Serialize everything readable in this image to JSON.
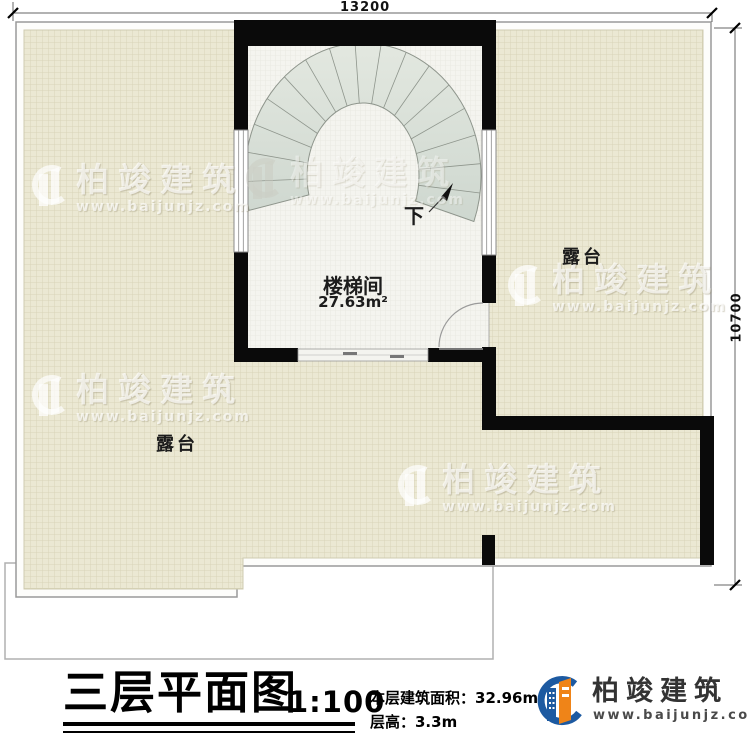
{
  "dimensions": {
    "top": "13200",
    "right": "10700"
  },
  "rooms": {
    "stair_room_label": "楼梯间",
    "stair_room_area": "27.63m²",
    "terrace_right_label": "露台",
    "terrace_bottom_label": "露台",
    "down_label": "下"
  },
  "title_block": {
    "title": "三层平面图",
    "scale": "1:100",
    "area_line": "本层建筑面积：32.96m²",
    "height_line": "层高：3.3m"
  },
  "logo": {
    "name": "柏竣建筑",
    "url": "www.baijunjz.com"
  },
  "watermark": {
    "name": "柏竣建筑",
    "url": "www.baijunjz.com"
  },
  "colors": {
    "terrace_fill": "#ebe8d3",
    "terrace_grid": "#d8d4b8",
    "room_fill": "#f4f4ef",
    "stair_fill": "#d9e0d7",
    "wall": "#0a0a0a",
    "logo_blue": "#1d5aa1",
    "logo_orange": "#ef8418"
  }
}
